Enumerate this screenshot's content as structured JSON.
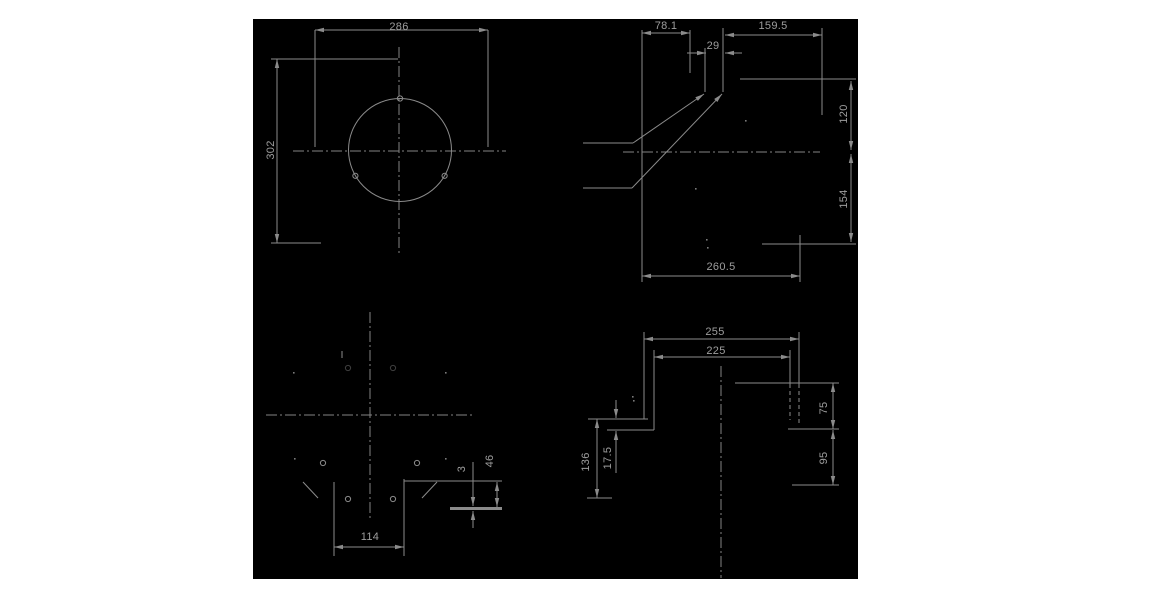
{
  "app": {
    "title": "CAD technical drawing — dimensioned part views",
    "background": "#ffffff"
  },
  "canvas": {
    "x": 253,
    "y": 19,
    "width": 605,
    "height": 560,
    "bg": "#000000",
    "line_color": "#8b8b8b",
    "center_color": "#848484",
    "text_color": "#9e9e9e",
    "speck_color": "#7a7a7a"
  },
  "views": {
    "top_left": {
      "name": "flange-front-view",
      "dimensions": [
        "286",
        "302"
      ]
    },
    "top_right": {
      "name": "side-profile-view",
      "dimensions": [
        "78.1",
        "29",
        "159.5",
        "120",
        "154",
        "260.5"
      ]
    },
    "bottom_left": {
      "name": "bottom-hole-pattern-view",
      "dimensions": [
        "114",
        "3",
        "46"
      ]
    },
    "bottom_right": {
      "name": "rear-step-view",
      "dimensions": [
        "255",
        "225",
        "136",
        "17.5",
        "75",
        "95"
      ]
    }
  },
  "drawing": {
    "labels": [
      {
        "t": "286",
        "x": 399,
        "y": 27,
        "r": 0
      },
      {
        "t": "302",
        "x": 271,
        "y": 150,
        "r": -90
      },
      {
        "t": "78.1",
        "x": 666,
        "y": 26,
        "r": 0
      },
      {
        "t": "29",
        "x": 713,
        "y": 46,
        "r": 0
      },
      {
        "t": "159.5",
        "x": 773,
        "y": 26,
        "r": 0
      },
      {
        "t": "120",
        "x": 844,
        "y": 114,
        "r": -90
      },
      {
        "t": "154",
        "x": 844,
        "y": 199,
        "r": -90
      },
      {
        "t": "260.5",
        "x": 721,
        "y": 267,
        "r": 0
      },
      {
        "t": "114",
        "x": 370,
        "y": 537,
        "r": 0
      },
      {
        "t": "3",
        "x": 462,
        "y": 469,
        "r": -90
      },
      {
        "t": "46",
        "x": 490,
        "y": 461,
        "r": -90
      },
      {
        "t": "255",
        "x": 715,
        "y": 332,
        "r": 0
      },
      {
        "t": "225",
        "x": 716,
        "y": 351,
        "r": 0
      },
      {
        "t": "136",
        "x": 586,
        "y": 462,
        "r": -90
      },
      {
        "t": "17.5",
        "x": 608,
        "y": 458,
        "r": -90
      },
      {
        "t": "75",
        "x": 824,
        "y": 408,
        "r": -90
      },
      {
        "t": "95",
        "x": 824,
        "y": 458,
        "r": -90
      }
    ],
    "lines": [
      {
        "x1": 315,
        "y1": 30,
        "x2": 488,
        "y2": 30,
        "t": "s",
        "a": "both"
      },
      {
        "x1": 315,
        "y1": 30,
        "x2": 315,
        "y2": 147,
        "t": "s",
        "a": "none"
      },
      {
        "x1": 488,
        "y1": 30,
        "x2": 488,
        "y2": 147,
        "t": "s",
        "a": "none"
      },
      {
        "x1": 271,
        "y1": 59,
        "x2": 398,
        "y2": 59,
        "t": "s",
        "a": "none"
      },
      {
        "x1": 271,
        "y1": 243,
        "x2": 321,
        "y2": 243,
        "t": "s",
        "a": "none"
      },
      {
        "x1": 277,
        "y1": 59,
        "x2": 277,
        "y2": 243,
        "t": "s",
        "a": "both"
      },
      {
        "x1": 399,
        "y1": 47,
        "x2": 399,
        "y2": 255,
        "t": "c",
        "a": "none"
      },
      {
        "x1": 293,
        "y1": 151,
        "x2": 506,
        "y2": 151,
        "t": "c",
        "a": "none"
      },
      {
        "x1": 642,
        "y1": 33,
        "x2": 690,
        "y2": 33,
        "t": "s",
        "a": "both"
      },
      {
        "x1": 642,
        "y1": 30,
        "x2": 642,
        "y2": 282,
        "t": "s",
        "a": "none"
      },
      {
        "x1": 690,
        "y1": 30,
        "x2": 690,
        "y2": 73,
        "t": "s",
        "a": "none"
      },
      {
        "x1": 687,
        "y1": 53,
        "x2": 706,
        "y2": 53,
        "t": "s",
        "a": "end"
      },
      {
        "x1": 742,
        "y1": 53,
        "x2": 725,
        "y2": 53,
        "t": "s",
        "a": "end"
      },
      {
        "x1": 705,
        "y1": 48,
        "x2": 705,
        "y2": 92,
        "t": "s",
        "a": "none"
      },
      {
        "x1": 723,
        "y1": 28,
        "x2": 723,
        "y2": 92,
        "t": "s",
        "a": "none"
      },
      {
        "x1": 725,
        "y1": 35,
        "x2": 822,
        "y2": 35,
        "t": "s",
        "a": "both"
      },
      {
        "x1": 822,
        "y1": 28,
        "x2": 822,
        "y2": 115,
        "t": "s",
        "a": "none"
      },
      {
        "x1": 740,
        "y1": 79,
        "x2": 856,
        "y2": 79,
        "t": "s",
        "a": "none"
      },
      {
        "x1": 851,
        "y1": 81,
        "x2": 851,
        "y2": 150,
        "t": "s",
        "a": "both"
      },
      {
        "x1": 851,
        "y1": 154,
        "x2": 851,
        "y2": 242,
        "t": "s",
        "a": "both"
      },
      {
        "x1": 623,
        "y1": 152,
        "x2": 820,
        "y2": 152,
        "t": "c",
        "a": "none"
      },
      {
        "x1": 583,
        "y1": 143,
        "x2": 633,
        "y2": 143,
        "t": "s",
        "a": "none"
      },
      {
        "x1": 633,
        "y1": 143,
        "x2": 704,
        "y2": 94,
        "t": "s",
        "a": "end"
      },
      {
        "x1": 583,
        "y1": 188,
        "x2": 632,
        "y2": 188,
        "t": "s",
        "a": "none"
      },
      {
        "x1": 632,
        "y1": 188,
        "x2": 722,
        "y2": 94,
        "t": "s",
        "a": "end"
      },
      {
        "x1": 762,
        "y1": 244,
        "x2": 856,
        "y2": 244,
        "t": "s",
        "a": "none"
      },
      {
        "x1": 800,
        "y1": 235,
        "x2": 800,
        "y2": 282,
        "t": "s",
        "a": "none"
      },
      {
        "x1": 642,
        "y1": 276,
        "x2": 800,
        "y2": 276,
        "t": "s",
        "a": "both"
      },
      {
        "x1": 370,
        "y1": 312,
        "x2": 370,
        "y2": 518,
        "t": "c",
        "a": "none"
      },
      {
        "x1": 266,
        "y1": 415,
        "x2": 473,
        "y2": 415,
        "t": "c",
        "a": "none"
      },
      {
        "x1": 334,
        "y1": 482,
        "x2": 334,
        "y2": 556,
        "t": "s",
        "a": "none"
      },
      {
        "x1": 404,
        "y1": 479,
        "x2": 404,
        "y2": 556,
        "t": "s",
        "a": "none"
      },
      {
        "x1": 334,
        "y1": 547,
        "x2": 404,
        "y2": 547,
        "t": "s",
        "a": "both"
      },
      {
        "x1": 404,
        "y1": 481,
        "x2": 502,
        "y2": 481,
        "t": "s",
        "a": "none"
      },
      {
        "x1": 450,
        "y1": 508.5,
        "x2": 502,
        "y2": 508.5,
        "t": "k",
        "a": "none"
      },
      {
        "x1": 473,
        "y1": 462,
        "x2": 473,
        "y2": 506,
        "t": "s",
        "a": "end"
      },
      {
        "x1": 473,
        "y1": 528,
        "x2": 473,
        "y2": 511,
        "t": "s",
        "a": "end"
      },
      {
        "x1": 497,
        "y1": 482,
        "x2": 497,
        "y2": 507,
        "t": "s",
        "a": "both"
      },
      {
        "x1": 303,
        "y1": 482,
        "x2": 318,
        "y2": 498,
        "t": "s",
        "a": "none"
      },
      {
        "x1": 437,
        "y1": 482,
        "x2": 422,
        "y2": 498,
        "t": "s",
        "a": "none"
      },
      {
        "x1": 342,
        "y1": 351,
        "x2": 342,
        "y2": 358,
        "t": "s",
        "a": "none"
      },
      {
        "x1": 644,
        "y1": 339,
        "x2": 799,
        "y2": 339,
        "t": "s",
        "a": "both"
      },
      {
        "x1": 654,
        "y1": 357,
        "x2": 790,
        "y2": 357,
        "t": "s",
        "a": "both"
      },
      {
        "x1": 644,
        "y1": 332,
        "x2": 644,
        "y2": 419,
        "t": "s",
        "a": "none"
      },
      {
        "x1": 654,
        "y1": 350,
        "x2": 654,
        "y2": 430,
        "t": "s",
        "a": "none"
      },
      {
        "x1": 799,
        "y1": 332,
        "x2": 799,
        "y2": 384,
        "t": "s",
        "a": "none"
      },
      {
        "x1": 799,
        "y1": 384,
        "x2": 799,
        "y2": 424,
        "t": "d",
        "a": "none"
      },
      {
        "x1": 790,
        "y1": 350,
        "x2": 790,
        "y2": 384,
        "t": "s",
        "a": "none"
      },
      {
        "x1": 790,
        "y1": 384,
        "x2": 790,
        "y2": 420,
        "t": "d",
        "a": "none"
      },
      {
        "x1": 721,
        "y1": 366,
        "x2": 721,
        "y2": 578,
        "t": "c",
        "a": "none"
      },
      {
        "x1": 735,
        "y1": 383,
        "x2": 839,
        "y2": 383,
        "t": "s",
        "a": "none"
      },
      {
        "x1": 833,
        "y1": 383,
        "x2": 833,
        "y2": 429,
        "t": "s",
        "a": "both"
      },
      {
        "x1": 788,
        "y1": 429,
        "x2": 839,
        "y2": 429,
        "t": "s",
        "a": "none"
      },
      {
        "x1": 833,
        "y1": 430,
        "x2": 833,
        "y2": 485,
        "t": "s",
        "a": "both"
      },
      {
        "x1": 792,
        "y1": 485,
        "x2": 839,
        "y2": 485,
        "t": "s",
        "a": "none"
      },
      {
        "x1": 588,
        "y1": 419,
        "x2": 648,
        "y2": 419,
        "t": "s",
        "a": "none"
      },
      {
        "x1": 607,
        "y1": 430,
        "x2": 654,
        "y2": 430,
        "t": "s",
        "a": "none"
      },
      {
        "x1": 616,
        "y1": 400,
        "x2": 616,
        "y2": 418,
        "t": "s",
        "a": "end"
      },
      {
        "x1": 616,
        "y1": 473,
        "x2": 616,
        "y2": 431,
        "t": "s",
        "a": "end"
      },
      {
        "x1": 597,
        "y1": 419,
        "x2": 597,
        "y2": 498,
        "t": "s",
        "a": "both"
      },
      {
        "x1": 587,
        "y1": 498,
        "x2": 612,
        "y2": 498,
        "t": "s",
        "a": "none"
      }
    ],
    "circles": [
      {
        "cx": 400,
        "cy": 150,
        "r": 51.5,
        "faint": false,
        "name": "flange-circle"
      },
      {
        "cx": 400,
        "cy": 98.5,
        "r": 2.6,
        "faint": false,
        "name": "hole-circle"
      },
      {
        "cx": 355.4,
        "cy": 175.8,
        "r": 2.6,
        "faint": false,
        "name": "hole-circle"
      },
      {
        "cx": 444.6,
        "cy": 175.8,
        "r": 2.6,
        "faint": false,
        "name": "hole-circle"
      },
      {
        "cx": 323,
        "cy": 463,
        "r": 2.6,
        "faint": false,
        "name": "hole-circle"
      },
      {
        "cx": 417,
        "cy": 463,
        "r": 2.6,
        "faint": false,
        "name": "hole-circle"
      },
      {
        "cx": 348,
        "cy": 499,
        "r": 2.6,
        "faint": false,
        "name": "hole-circle"
      },
      {
        "cx": 393,
        "cy": 499,
        "r": 2.6,
        "faint": false,
        "name": "hole-circle"
      },
      {
        "cx": 348,
        "cy": 368,
        "r": 2.6,
        "faint": true,
        "name": "hole-circle-faint"
      },
      {
        "cx": 393,
        "cy": 368,
        "r": 2.6,
        "faint": true,
        "name": "hole-circle-faint"
      }
    ],
    "specks": [
      {
        "x": 745,
        "y": 120
      },
      {
        "x": 695,
        "y": 188
      },
      {
        "x": 706,
        "y": 239
      },
      {
        "x": 707,
        "y": 247
      },
      {
        "x": 293,
        "y": 372
      },
      {
        "x": 445,
        "y": 372
      },
      {
        "x": 294,
        "y": 458
      },
      {
        "x": 445,
        "y": 458
      },
      {
        "x": 633,
        "y": 400
      },
      {
        "x": 632,
        "y": 396
      }
    ]
  }
}
